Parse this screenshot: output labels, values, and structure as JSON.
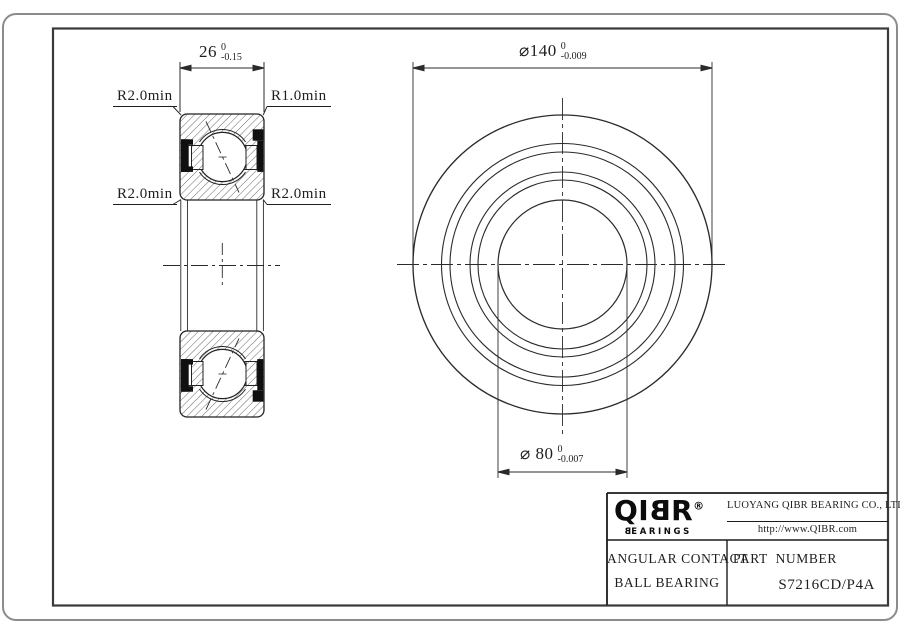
{
  "drawing": {
    "dim_width": {
      "value": "26",
      "tol_upper": "0",
      "tol_lower": "-0.15"
    },
    "dim_od": {
      "text": "⌀140",
      "tol_upper": "0",
      "tol_lower": "-0.009"
    },
    "dim_bore": {
      "text": "⌀ 80",
      "tol_upper": "0",
      "tol_lower": "-0.007"
    },
    "labels": {
      "top_left": "R2.0min",
      "top_right": "R1.0min",
      "bottom_left": "R2.0min",
      "bottom_right": "R2.0min"
    }
  },
  "title_block": {
    "logo": {
      "part1": "QI",
      "part_flipped": "B",
      "part2": "R",
      "registered": "®",
      "sub_flipped": "B",
      "sub_rest": "EARINGS"
    },
    "company": "LUOYANG QIBR BEARING CO., LTD",
    "website": "http://www.QIBR.com",
    "product_line1": "ANGULAR CONTACT",
    "product_line2": "BALL BEARING",
    "part_number_label": "PART  NUMBER",
    "part_number": "S7216CD/P4A"
  },
  "colors": {
    "line": "#2b2b2b",
    "frame": "#3a3a3a",
    "outer_border": "#8c8c8c",
    "seal_fill": "#101010"
  }
}
